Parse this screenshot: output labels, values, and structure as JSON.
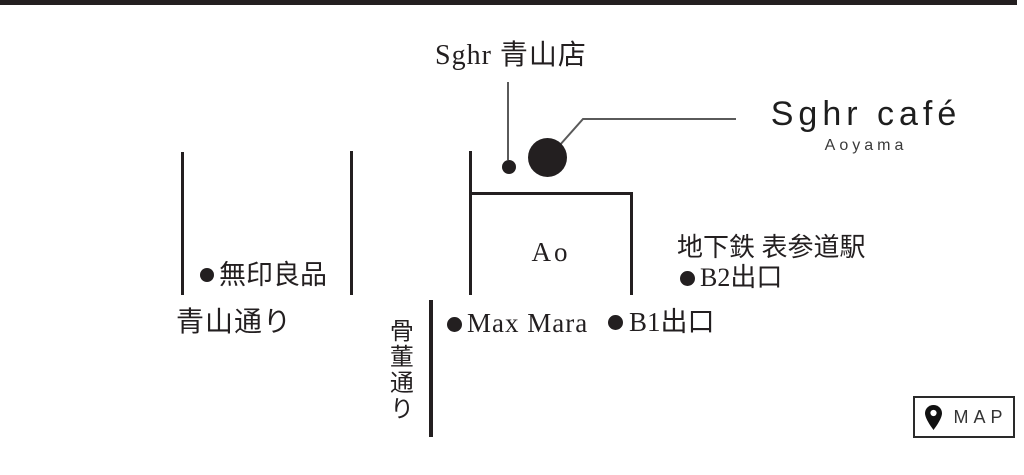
{
  "store_label": {
    "text": "Sghr 青山店"
  },
  "cafe": {
    "title": "Sghr café",
    "subtitle": "Aoyama"
  },
  "building": {
    "label": "Ao"
  },
  "station": {
    "name": "地下鉄 表参道駅",
    "exit_b2": "B2出口",
    "exit_b1": "B1出口"
  },
  "landmarks": {
    "muji": "無印良品",
    "max_mara": "Max Mara"
  },
  "streets": {
    "aoyama_dori": "青山通り",
    "kotto_dori": "骨董通り"
  },
  "map_button": {
    "label": "MAP"
  },
  "colors": {
    "ink": "#231f20",
    "leader_line": "#5a5a5a",
    "background": "#ffffff"
  }
}
